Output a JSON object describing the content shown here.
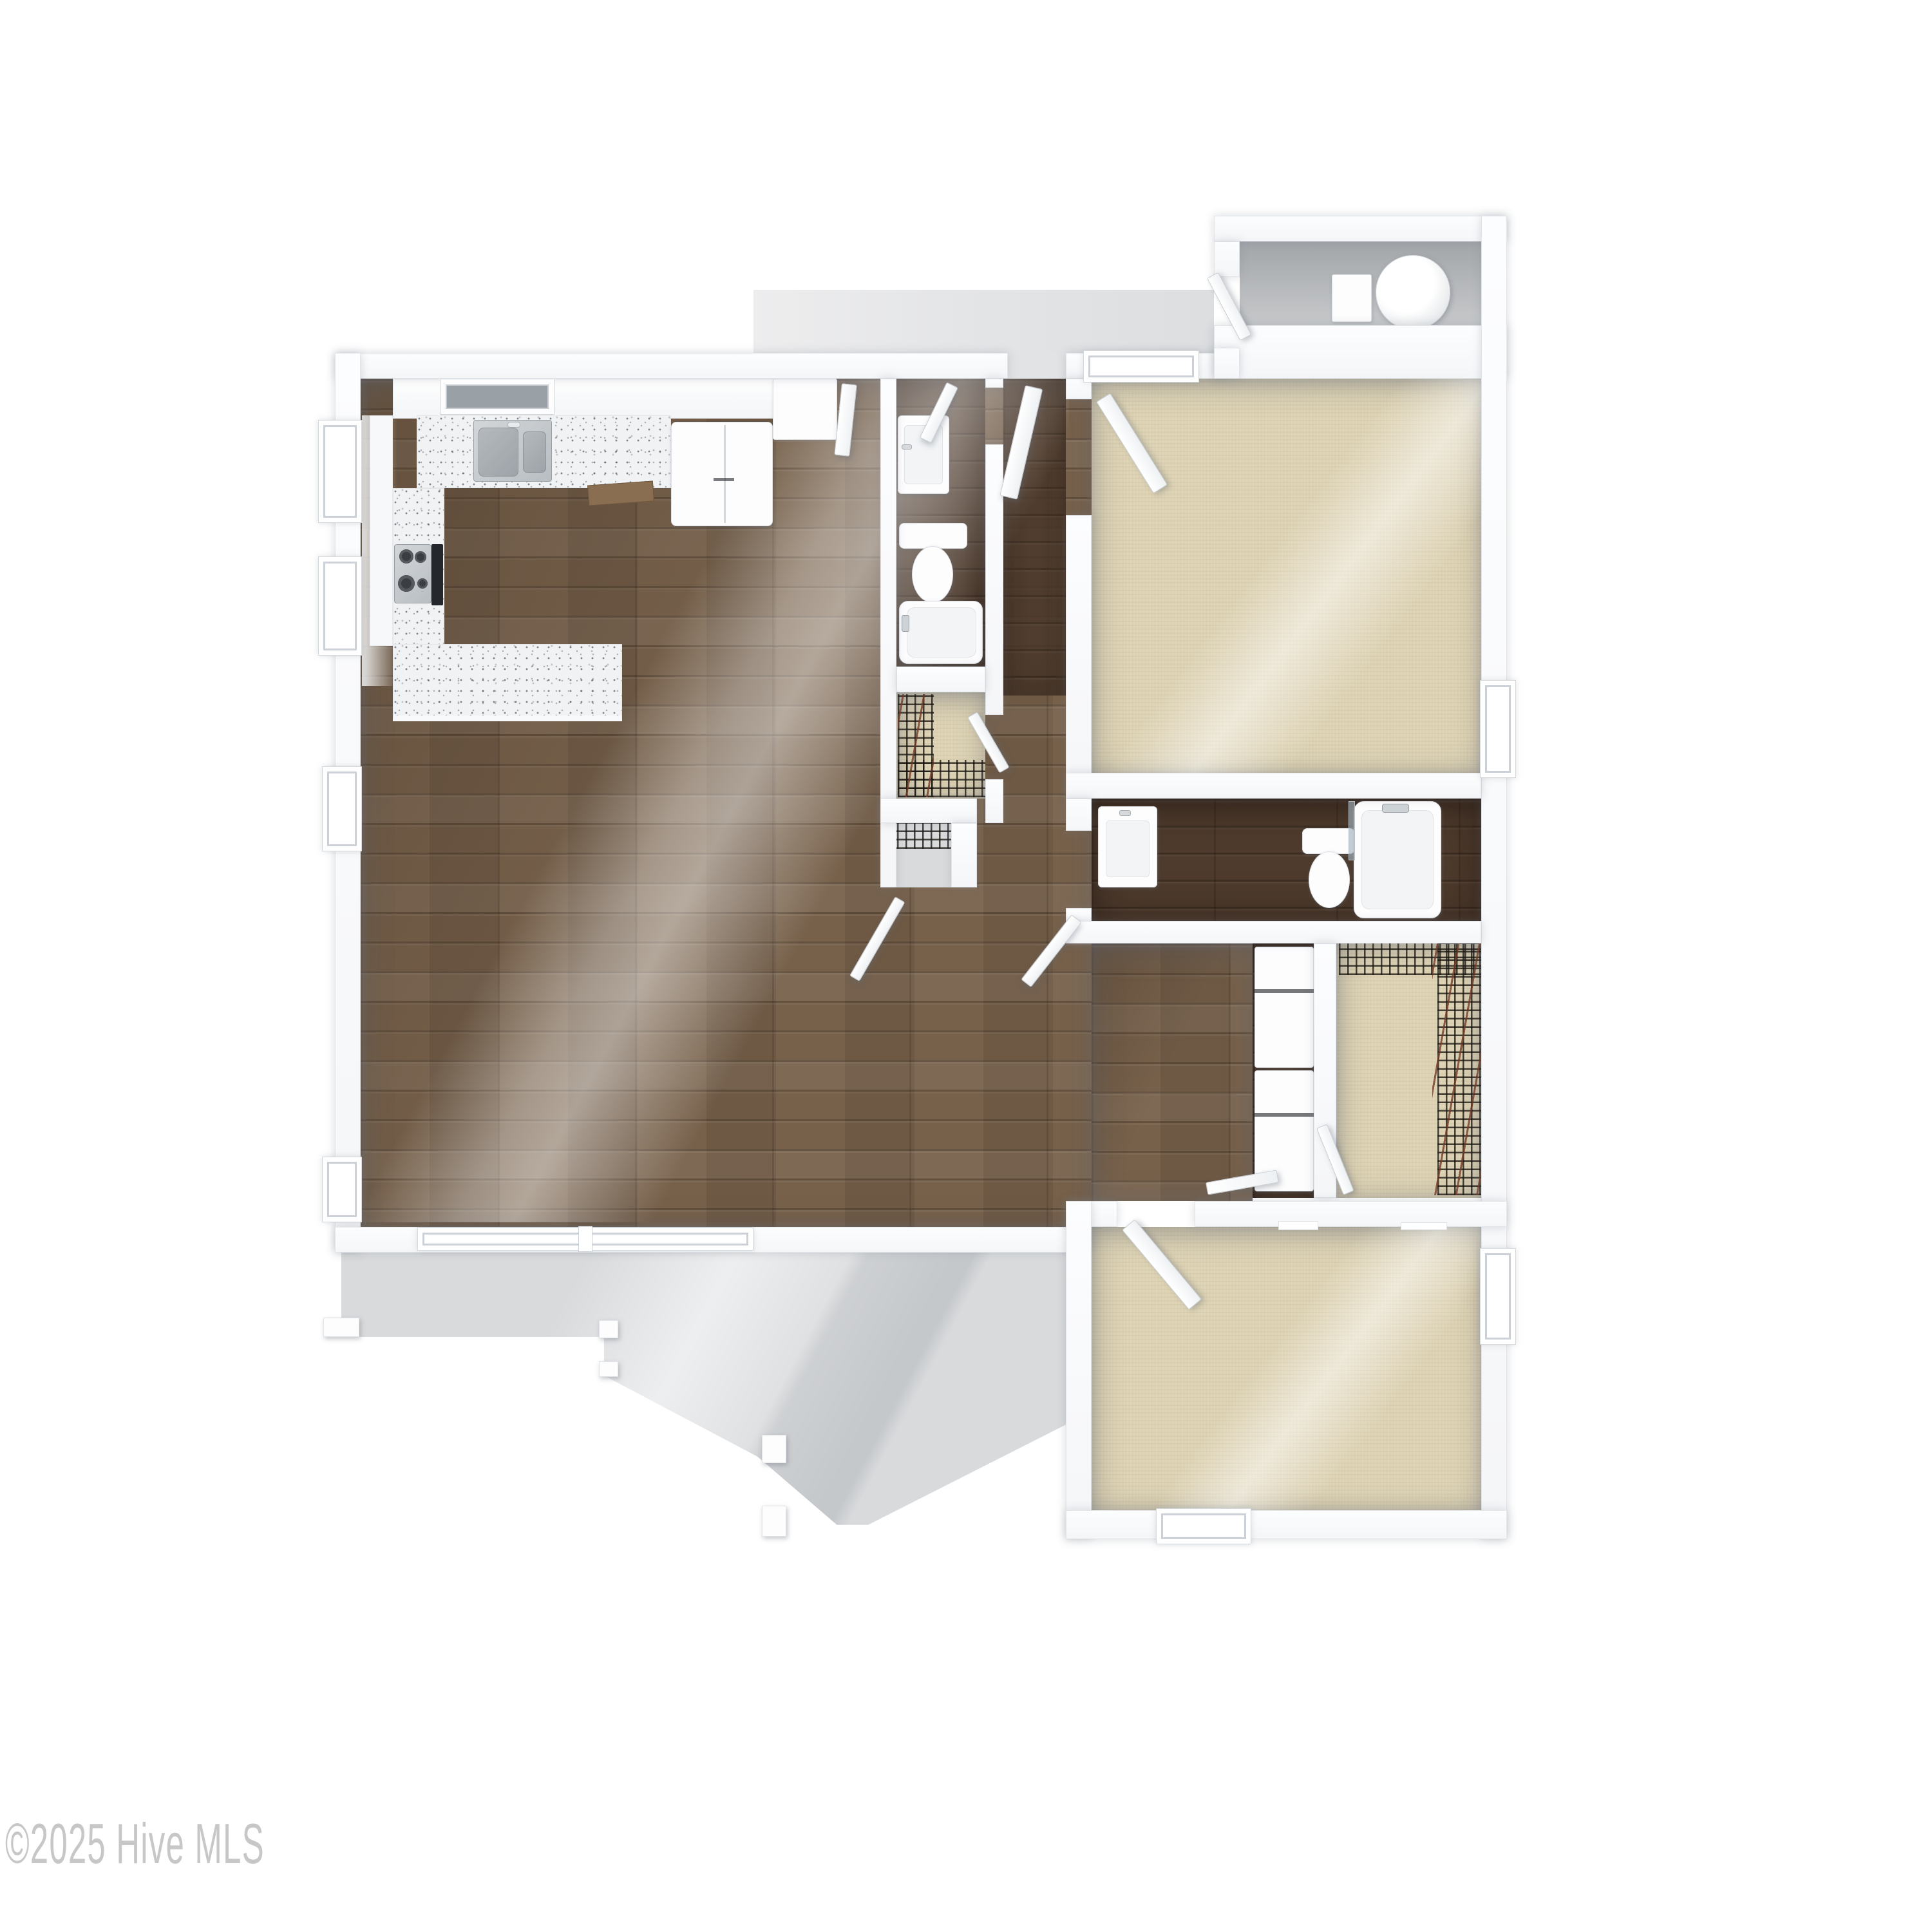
{
  "watermark": {
    "text": "©2025 Hive MLS",
    "color": "#c7c7c7"
  },
  "palette": {
    "wall-fill": "#fcfdfe",
    "wall-edge": "#e2e5e9",
    "wood": "#77614b",
    "wood-dark": "#4e3b2d",
    "carpet": "#ddd2b3",
    "concrete-light": "#e4e5e7",
    "concrete-mid": "#d8dadc",
    "concrete-dark": "#a2a5a8",
    "granite": "#f1f2f4",
    "steel": "#b9bec2",
    "fixture-white": "#fdfdfe",
    "oven-black": "#24272b",
    "dishwasher-wood": "#8a6e52",
    "wire-shelf": "#25211c",
    "hanger-brown": "#7d452f"
  },
  "plan": {
    "type": "3d-floor-plan-top-down-render",
    "rooms": [
      {
        "name": "kitchen",
        "floor": "wood",
        "fixtures": [
          "double-stainless-sink",
          "gas-cooktop",
          "oven",
          "refrigerator",
          "pantry-cabinet",
          "dishwasher-door",
          "granite-counter-l",
          "granite-peninsula"
        ]
      },
      {
        "name": "living-dining-area",
        "floor": "wood",
        "fixtures": []
      },
      {
        "name": "hallway",
        "floor": "wood",
        "fixtures": []
      },
      {
        "name": "bathroom-1",
        "floor": "wood-dark",
        "fixtures": [
          "vanity-sink",
          "toilet",
          "bathtub"
        ]
      },
      {
        "name": "walk-in-closet-1",
        "floor": "carpet",
        "fixtures": [
          "wire-shelving"
        ]
      },
      {
        "name": "linen-closet",
        "floor": "concrete-light",
        "fixtures": [
          "wire-shelf"
        ]
      },
      {
        "name": "bedroom-1",
        "floor": "carpet",
        "windows": 2
      },
      {
        "name": "bathroom-2",
        "floor": "wood-dark",
        "fixtures": [
          "vanity-sink",
          "toilet",
          "bathtub-shower"
        ]
      },
      {
        "name": "laundry-closet",
        "floor": "wood-dark",
        "fixtures": [
          "washer",
          "dryer"
        ]
      },
      {
        "name": "walk-in-closet-2",
        "floor": "carpet",
        "fixtures": [
          "wire-shelving",
          "wood-hangers"
        ]
      },
      {
        "name": "bedroom-2",
        "floor": "carpet",
        "windows": 2
      },
      {
        "name": "entry-walkway",
        "floor": "concrete",
        "fixtures": [
          "front-door"
        ]
      },
      {
        "name": "exterior-storage-closet",
        "floor": "concrete",
        "fixtures": [
          "water-heater",
          "utility-box"
        ]
      },
      {
        "name": "patio",
        "floor": "concrete",
        "fixtures": [
          "porch-posts"
        ]
      }
    ]
  }
}
